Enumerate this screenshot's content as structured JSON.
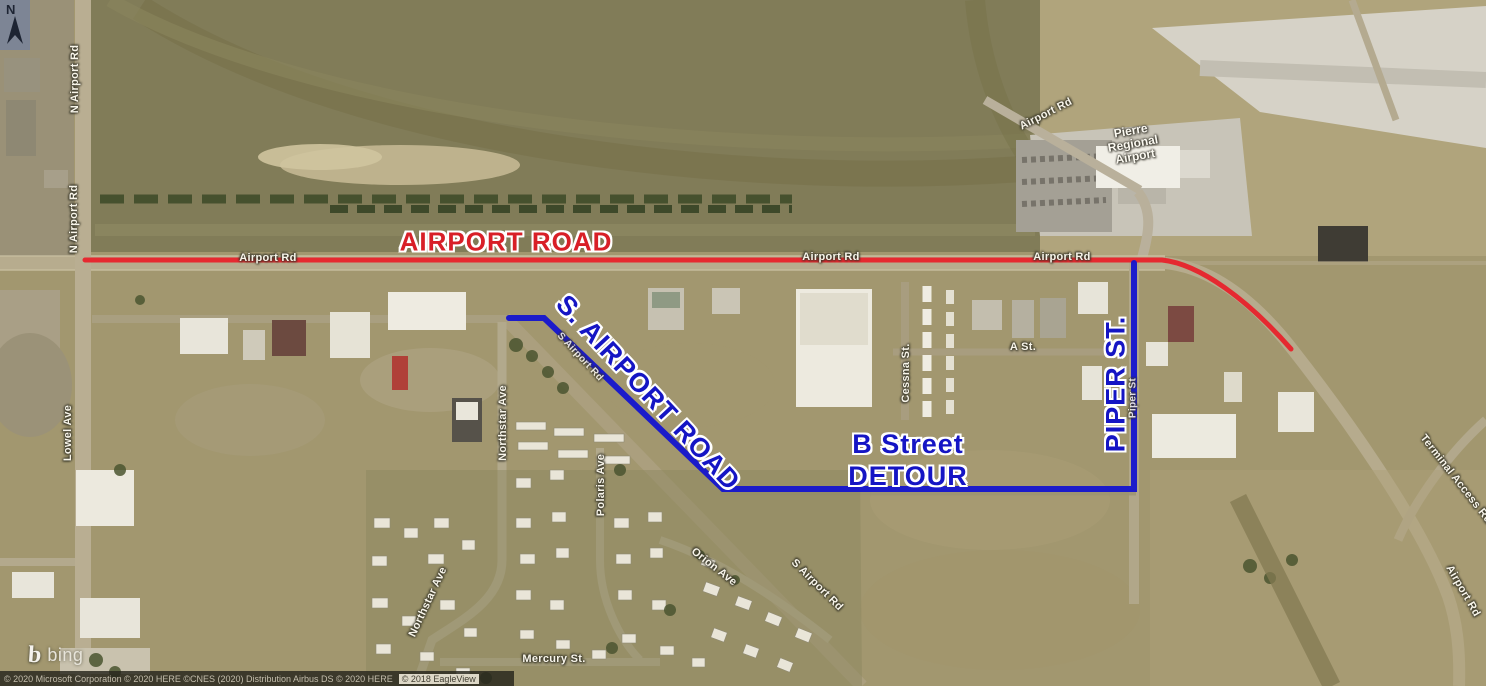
{
  "map_overlay": {
    "closed_road_label": "AIRPORT ROAD",
    "s_airport_road_label": "S. AIRPORT ROAD",
    "b_street_detour_line1": "B Street",
    "b_street_detour_line2": "DETOUR",
    "piper_st_label": "PIPER ST.",
    "colors": {
      "closed_road": "#e8222b",
      "detour_route": "#1414cf"
    }
  },
  "road_labels": [
    {
      "text": "N Airport Rd"
    },
    {
      "text": "N Airport Rd"
    },
    {
      "text": "Lowel Ave"
    },
    {
      "text": "Airport Rd"
    },
    {
      "text": "Airport Rd"
    },
    {
      "text": "Airport Rd"
    },
    {
      "text": "Airport Rd"
    },
    {
      "text": "Airport Rd"
    },
    {
      "text": "A St."
    },
    {
      "text": "Cessna St."
    },
    {
      "text": "Northstar Ave"
    },
    {
      "text": "Northstar Ave"
    },
    {
      "text": "Polaris Ave"
    },
    {
      "text": "Orion Ave"
    },
    {
      "text": "Mercury St."
    },
    {
      "text": "S Airport Rd"
    },
    {
      "text": "Terminal Access Rd"
    },
    {
      "text": "S Airport Rd"
    },
    {
      "text": "Piper St"
    }
  ],
  "poi": {
    "airport_line1": "Pierre",
    "airport_line2": "Regional",
    "airport_line3": "Airport"
  },
  "compass": {
    "label": "N"
  },
  "attribution": {
    "brand": "bing",
    "copyright": "© 2020 Microsoft Corporation © 2020 HERE ©CNES (2020) Distribution Airbus DS © 2020 HERE",
    "imagery_badge": "© 2018 EagleView"
  }
}
